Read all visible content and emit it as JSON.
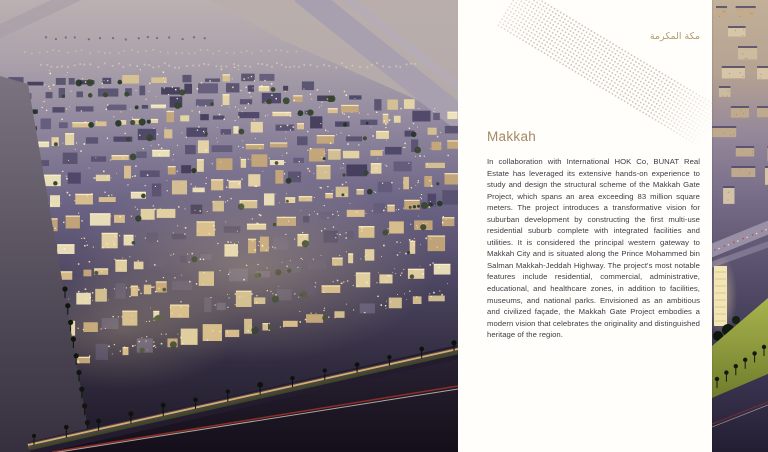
{
  "panel": {
    "arabic_title": "مكة المكرمة",
    "heading": "Makkah",
    "body": "In collaboration with International HOK Co, BUNAT Real Estate has leveraged its extensive hands-on experience to study and design the structural scheme of the Makkah Gate Project, which spans an area exceeding 83 million square meters. The project introduces a transformative vision for suburban development by constructing the first multi-use residential suburb complete with integrated facilities and utilities. It is considered the principal western gateway to Makkah City and is situated along the Prince Mohammed bin Salman Makkah-Jeddah Highway. The project's most notable features include residential, commercial, administrative, educational, and healthcare zones, in addition to facilities, museums, and national parks. Envisioned as an ambitious and civilized façade, the Makkah Gate Project embodies a modern vision that celebrates the originality and distinguished heritage of the region.",
    "colors": {
      "accent_heading": "#a38a63",
      "accent_arabic": "#b59c72",
      "body_text": "#3d3d44",
      "dot_pattern": "#ccc4b6",
      "panel_background": "#fffefb"
    }
  },
  "left_image": {
    "description": "aerial-night-render-of-makkah-gate-suburb"
  },
  "right_strip": {
    "description": "edge-of-next-page-dusk-render"
  }
}
